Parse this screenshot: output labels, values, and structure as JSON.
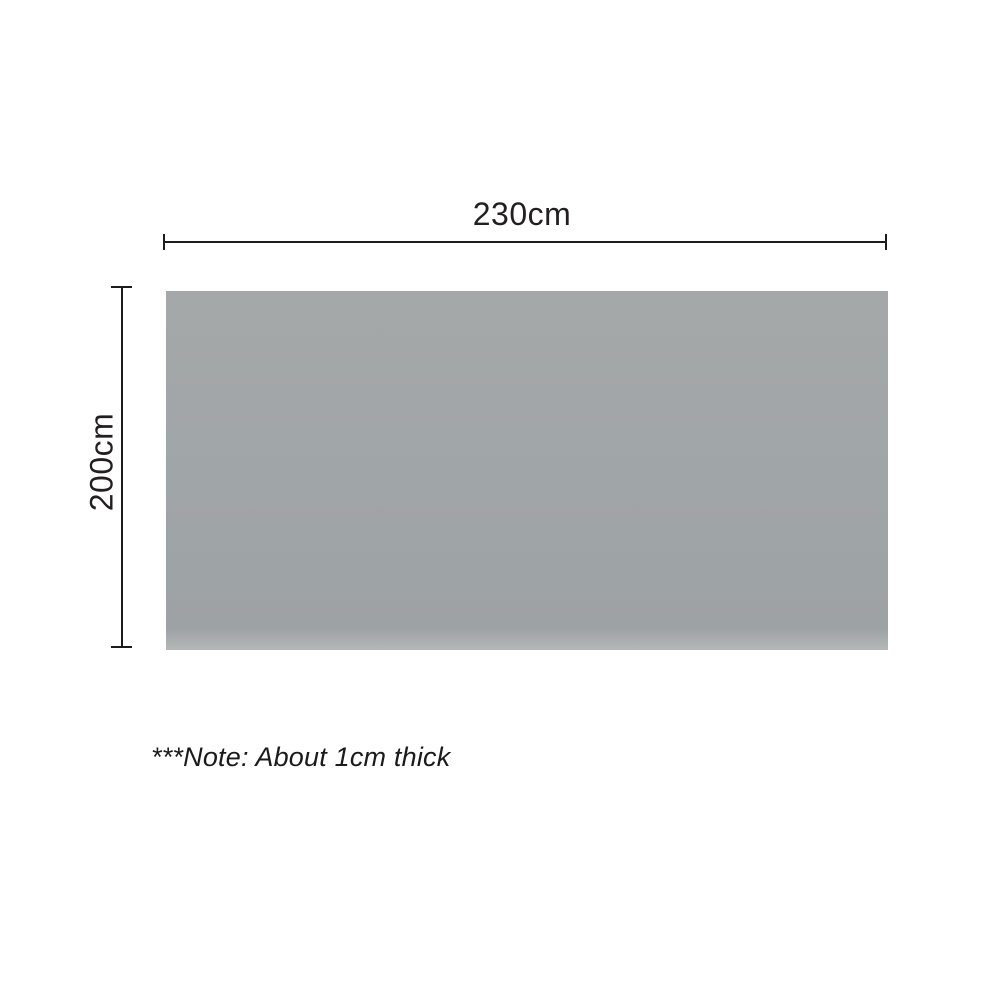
{
  "diagram": {
    "width_label": "230cm",
    "height_label": "200cm",
    "note": "***Note: About 1cm thick",
    "colors": {
      "product_fill": "#a0a5a7",
      "dimension_line": "#1c1c1c",
      "text": "#231f20",
      "background": "#ffffff"
    }
  }
}
